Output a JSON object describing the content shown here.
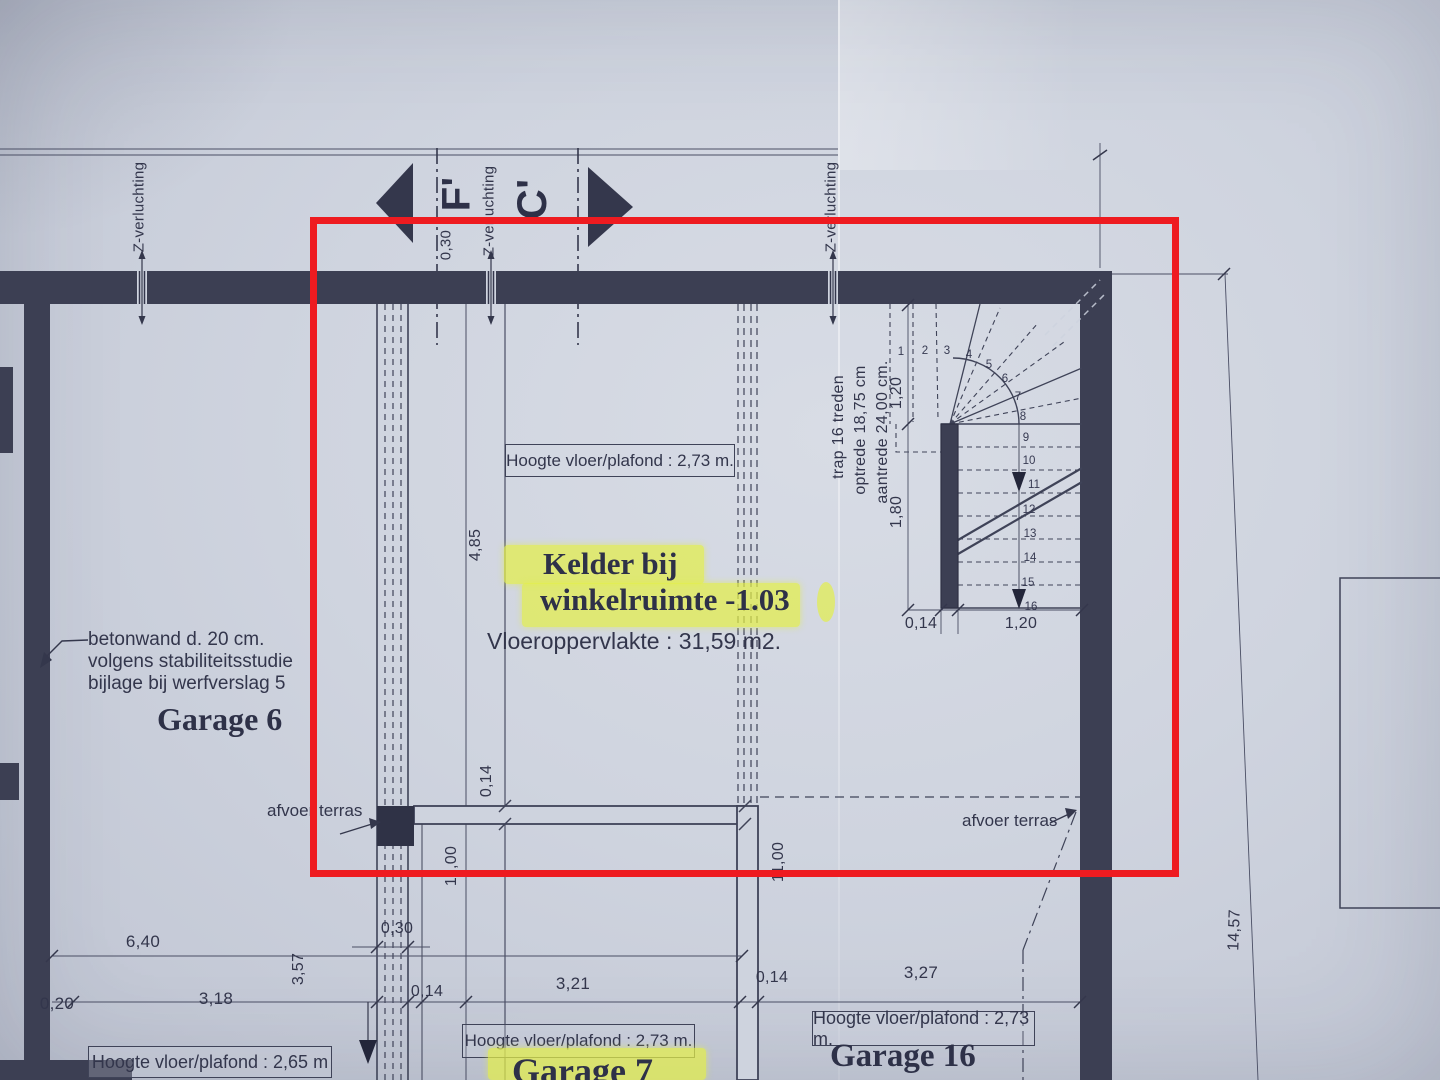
{
  "annotation": {
    "color": "#ee1b20"
  },
  "section_markers": {
    "left": "F'",
    "right": "C'"
  },
  "labels": {
    "vent": "Z-verluchting",
    "afvoer_left": "afvoer terras",
    "afvoer_right": "afvoer terras",
    "betonwand_1": "betonwand d. 20 cm.",
    "betonwand_2": "volgens stabiliteitsstudie",
    "betonwand_3": "bijlage bij werfverslag 5"
  },
  "rooms": {
    "kelder": {
      "name_1": "Kelder bij",
      "name_2": "winkelruimte -1.03",
      "area": "Vloeroppervlakte : 31,59 m2.",
      "height": "Hoogte vloer/plafond : 2,73 m."
    },
    "garage6": {
      "name": "Garage 6",
      "height": "Hoogte vloer/plafond : 2,65 m"
    },
    "garage7": {
      "name": "Garage 7",
      "height": "Hoogte vloer/plafond : 2,73 m."
    },
    "garage16": {
      "name": "Garage 16",
      "height": "Hoogte vloer/plafond : 2,73 m."
    }
  },
  "stair": {
    "note_1": "trap 16 treden",
    "note_2": "optrede 18,75 cm",
    "note_3": "aantrede 24,00 cm.",
    "treads": [
      "1",
      "2",
      "3",
      "4",
      "5",
      "6",
      "7",
      "8",
      "9",
      "10",
      "11",
      "12",
      "13",
      "14",
      "15",
      "16"
    ],
    "dims": {
      "upper": "1,20",
      "side": "1,80",
      "newel": "0,14",
      "width": "1,20"
    }
  },
  "dims": {
    "top_offset": "0,30",
    "kelder_h1": "4,85",
    "kelder_wall": "0,14",
    "kelder_depth_l": "11,00",
    "kelder_depth_r": "11,00",
    "garage6_w": "6,40",
    "wall_left": "0,20",
    "garage6_inner": "3,18",
    "garage6_d": "3,57",
    "shaft_w": "0,30",
    "shaft_wall": "0,14",
    "garage7_w": "3,21",
    "mid_wall": "0,14",
    "garage16_w": "3,27",
    "total_right": "14,57"
  }
}
